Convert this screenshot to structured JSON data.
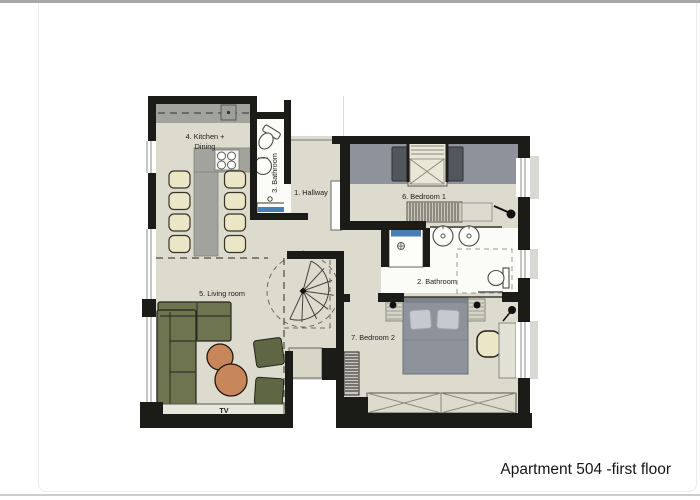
{
  "card": {
    "title": "Apartment 504 -first floor"
  },
  "floor_plan": {
    "rooms": {
      "hallway": {
        "label": "1. Hallway"
      },
      "bathroom2": {
        "label": "2. Bathroom"
      },
      "bathroom3": {
        "label": "3. Bathroom"
      },
      "kitchen": {
        "label_line1": "4. Kitchen +",
        "label_line2": "Dining"
      },
      "living": {
        "label": "5. Living room"
      },
      "bedroom1": {
        "label": "6. Bedroom 1"
      },
      "bedroom2": {
        "label": "7. Bedroom 2"
      }
    },
    "annotations": {
      "tv": "TV"
    },
    "colors": {
      "wall": "#1b1b18",
      "floor_beige": "#dcdbcd",
      "bathroom_white": "#fbfbf7",
      "counter_gray": "#a2a39d",
      "bed_gray": "#8e939b",
      "dark_unit_gray": "#53575d",
      "sofa_green": "#6e7450",
      "ottoman_green": "#5f6644",
      "table_orange": "#c8875a",
      "chair_cream": "#eae6c6",
      "shower_blue": "#4a7fb5"
    }
  }
}
